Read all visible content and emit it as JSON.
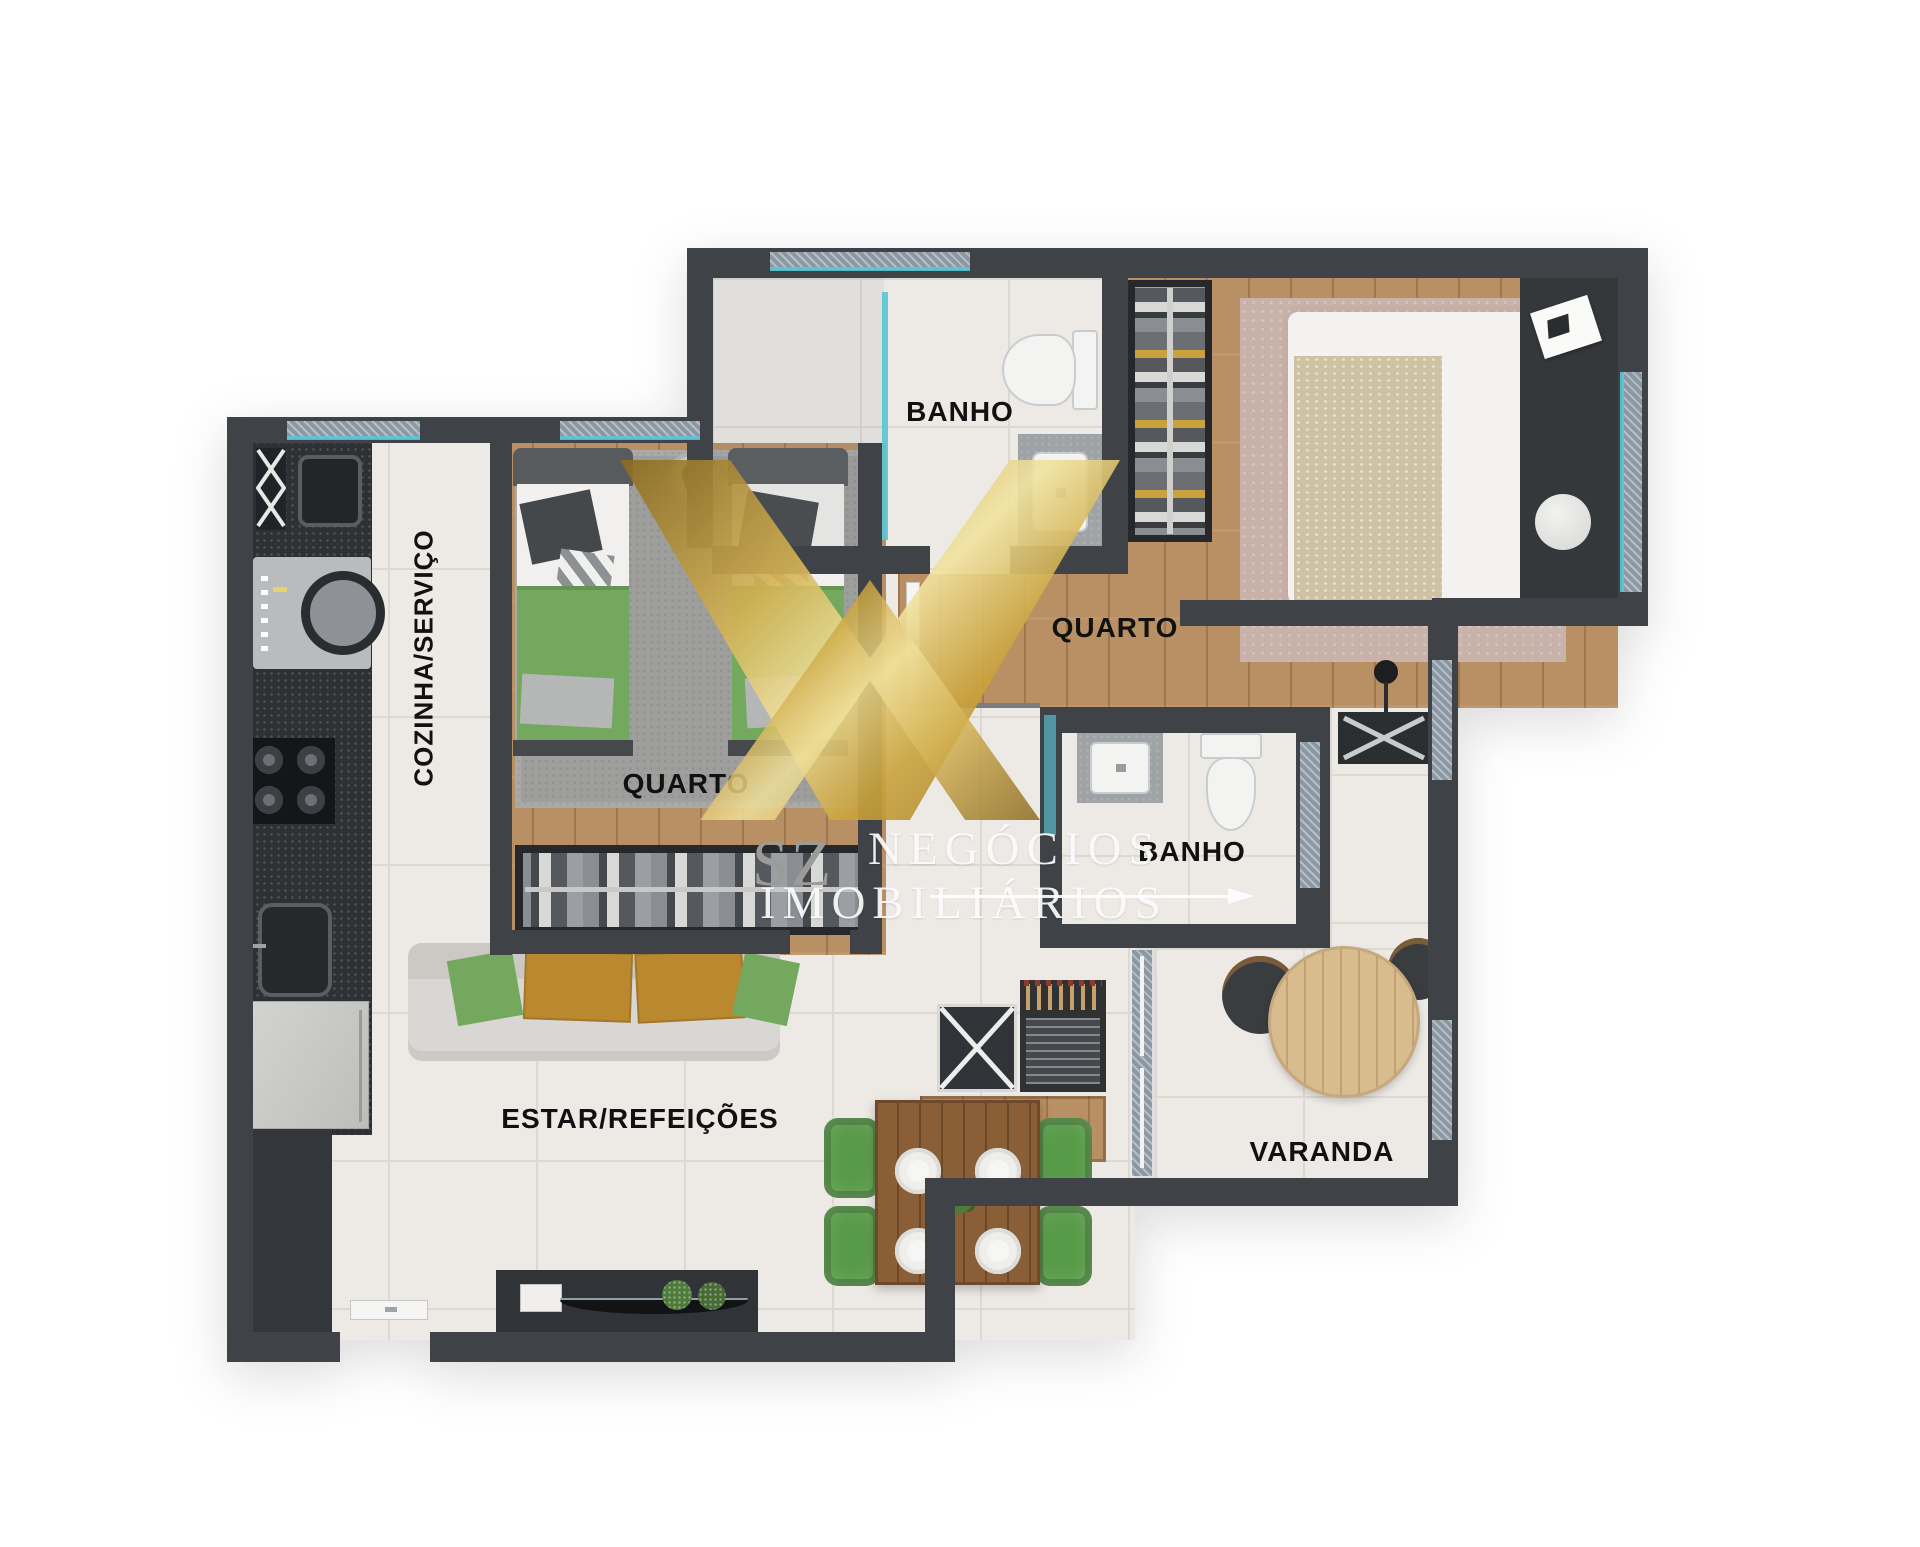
{
  "rooms": {
    "banho_suite": {
      "label": "BANHO"
    },
    "quarto_casal": {
      "label": "QUARTO"
    },
    "quarto_solteiro": {
      "label": "QUARTO"
    },
    "cozinha_servico": {
      "label": "COZINHA/SERVIÇO"
    },
    "banho_social": {
      "label": "BANHO"
    },
    "estar_refeicoes": {
      "label": "ESTAR/REFEIÇÕES"
    },
    "varanda": {
      "label": "VARANDA"
    }
  },
  "watermark": {
    "monogram_text": "SZ",
    "name_line1": "NEGÓCIOS",
    "name_line2": "IMOBILIÁRIOS"
  },
  "palette": {
    "wall": "#3f4246",
    "tile_floor": "#edeae6",
    "wood_floor": "#b98f64",
    "accent_teal": "#58c5d4",
    "brand_gold": "#caa33c",
    "furniture_green": "#6fae5e",
    "pillow_mustard": "#b9882f",
    "rug_gray": "#9e9e9c",
    "rug_mauve": "#c9b2aa"
  }
}
